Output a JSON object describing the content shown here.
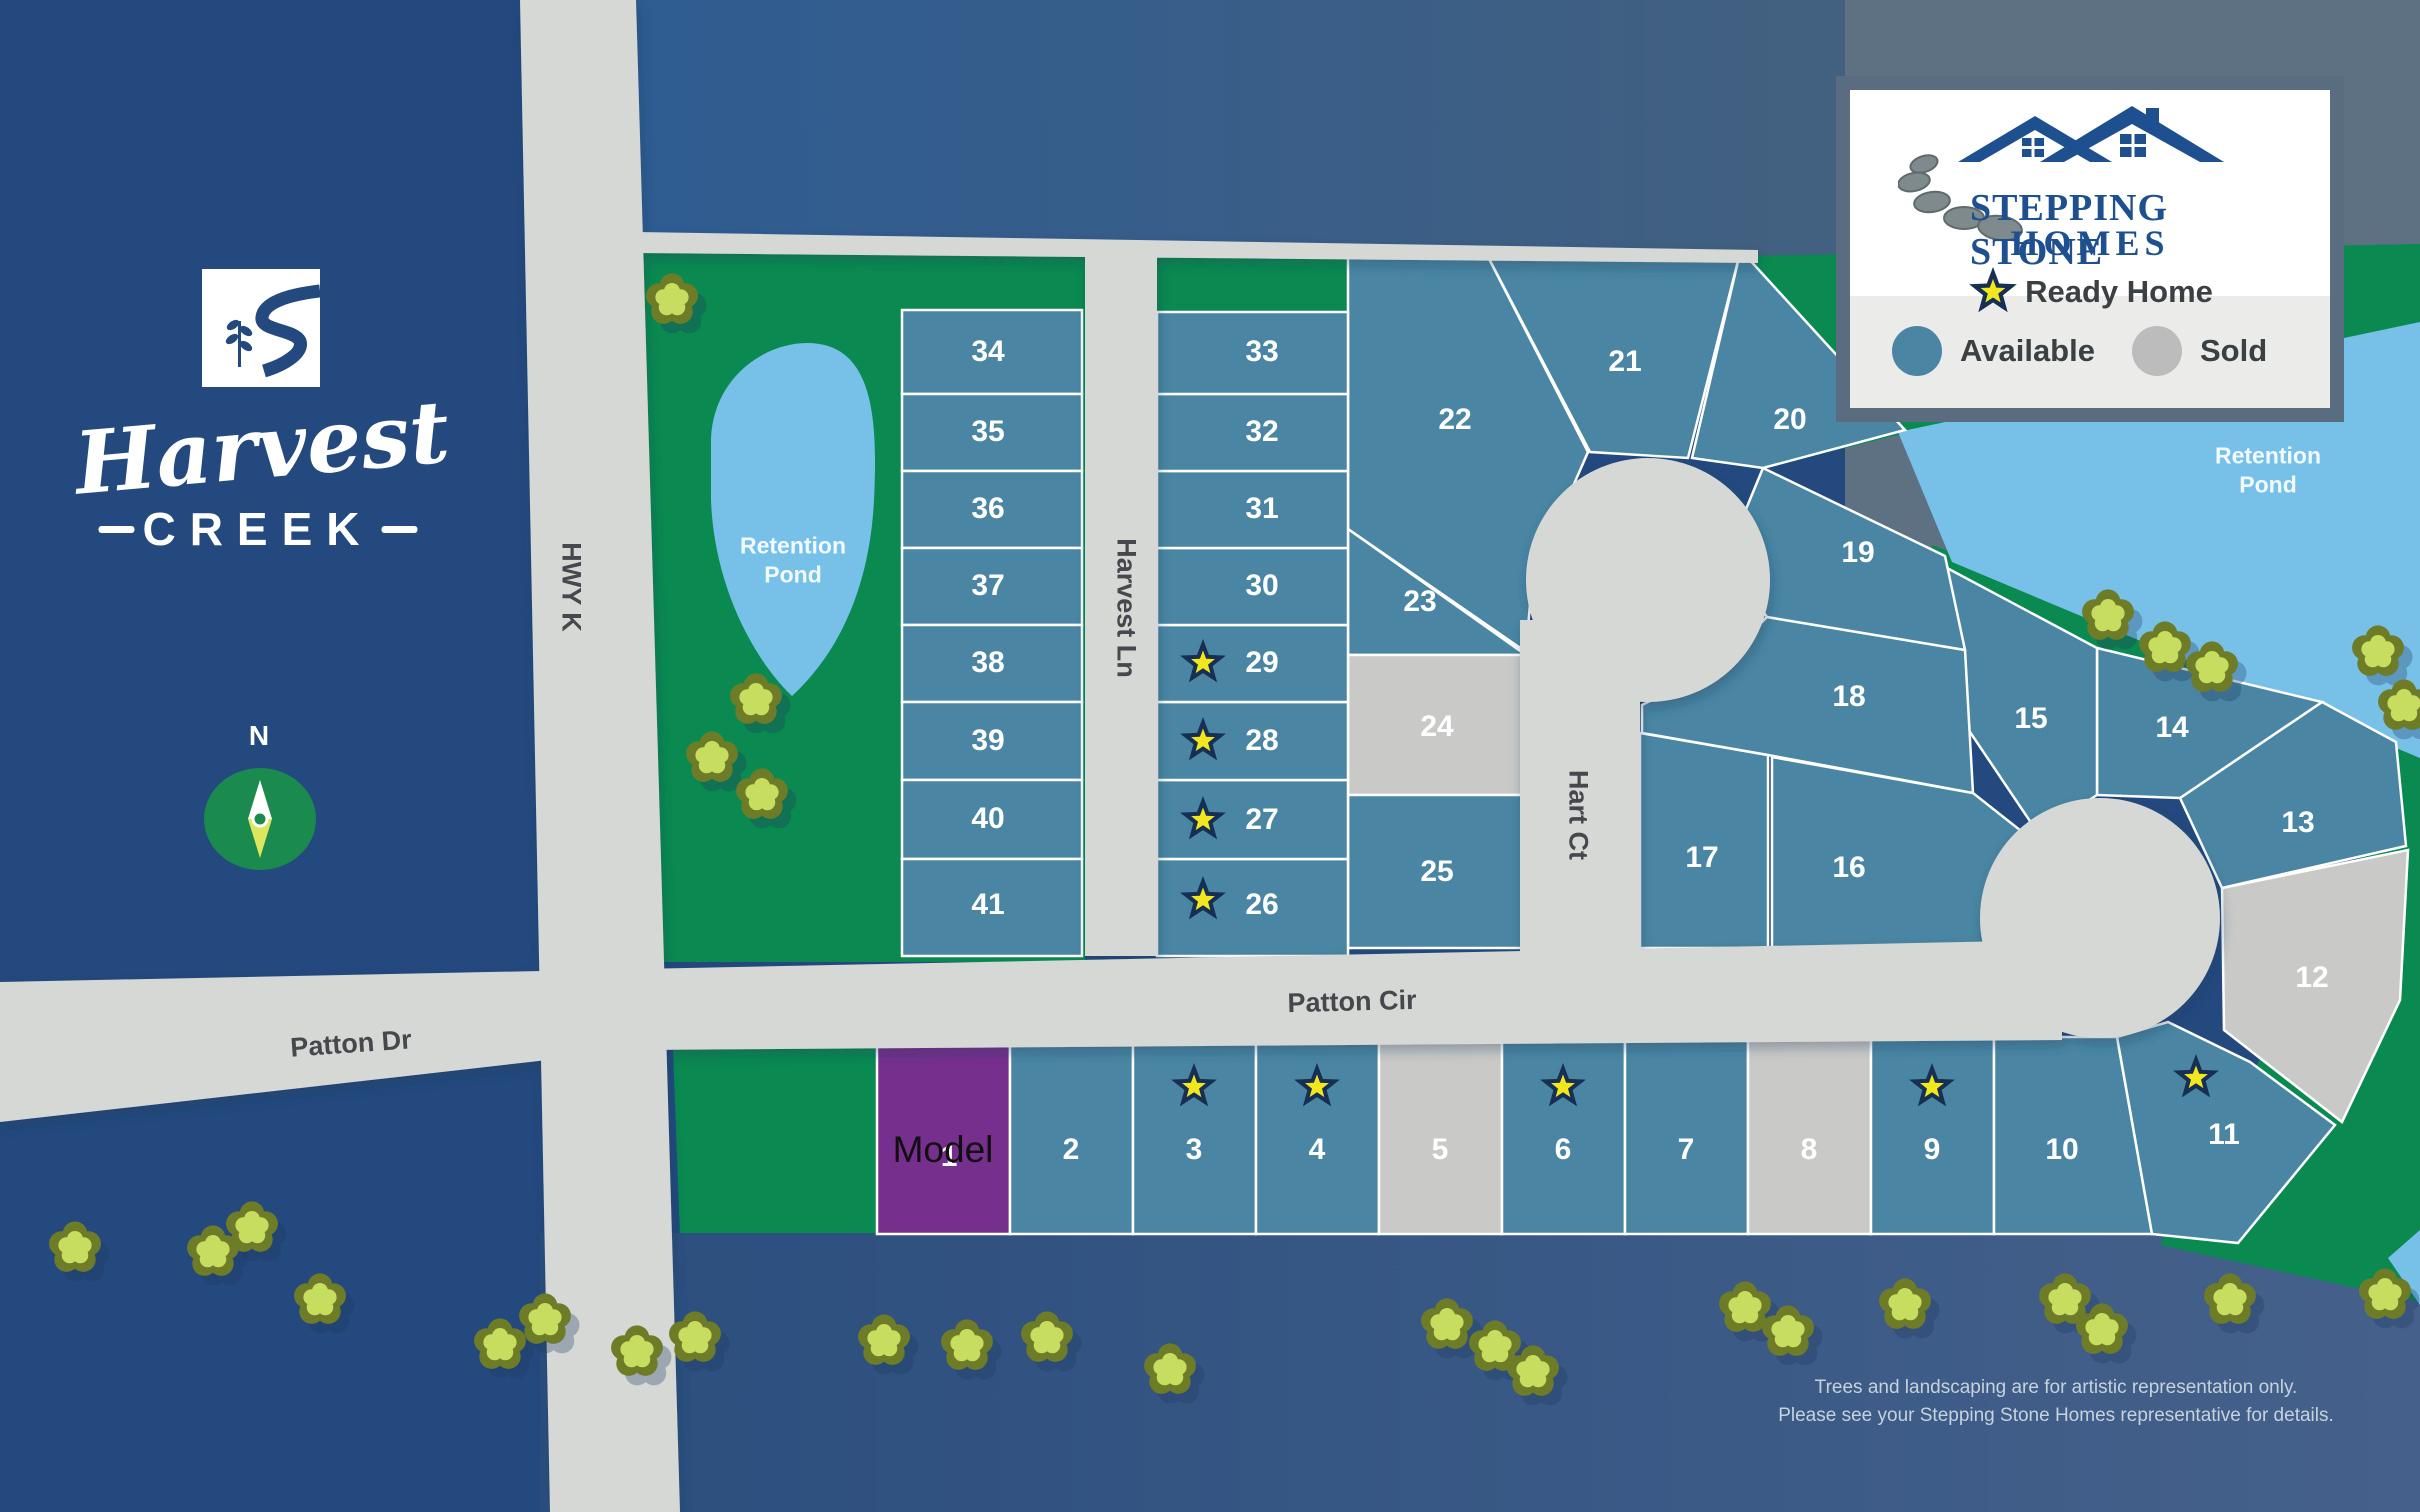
{
  "community": {
    "name_script": "Harvest",
    "name_caps": "CREEK",
    "compass_label": "N"
  },
  "legend": {
    "brand_line1": "STEPPING STONE",
    "brand_line2": "HOMES",
    "ready_home_label": "Ready Home",
    "available_label": "Available",
    "sold_label": "Sold"
  },
  "roads": {
    "hwy_k": "HWY K",
    "harvest_ln": "Harvest Ln",
    "hart_ct": "Hart Ct",
    "patton_cir": "Patton Cir",
    "patton_dr": "Patton Dr"
  },
  "ponds": {
    "left_label": "Retention Pond",
    "right_label": "Retention Pond"
  },
  "disclaimer": {
    "line1": "Trees and landscaping are for artistic representation only.",
    "line2": "Please see your Stepping Stone Homes representative for details."
  },
  "colors": {
    "available_teal": "#4a86a3",
    "sold_gray": "#c9c9c7",
    "model_purple": "#772f8e",
    "map_green": "#0a8a50",
    "pond_blue": "#77c1e9",
    "road_gray": "#d6d8d5",
    "navy_panel": "#24497e",
    "star_navy": "#162f52",
    "star_yellow": "#f2e71e",
    "brand_blue": "#1e4f8f"
  },
  "lots": [
    {
      "number": "1",
      "status": "model",
      "star": false,
      "model_text": "Model"
    },
    {
      "number": "2",
      "status": "available",
      "star": false
    },
    {
      "number": "3",
      "status": "available",
      "star": true
    },
    {
      "number": "4",
      "status": "available",
      "star": true
    },
    {
      "number": "5",
      "status": "sold",
      "star": false
    },
    {
      "number": "6",
      "status": "available",
      "star": true
    },
    {
      "number": "7",
      "status": "available",
      "star": false
    },
    {
      "number": "8",
      "status": "sold",
      "star": false
    },
    {
      "number": "9",
      "status": "available",
      "star": true
    },
    {
      "number": "10",
      "status": "available",
      "star": false
    },
    {
      "number": "11",
      "status": "available",
      "star": true
    },
    {
      "number": "12",
      "status": "sold",
      "star": false
    },
    {
      "number": "13",
      "status": "available",
      "star": false
    },
    {
      "number": "14",
      "status": "available",
      "star": false
    },
    {
      "number": "15",
      "status": "available",
      "star": false
    },
    {
      "number": "16",
      "status": "available",
      "star": false
    },
    {
      "number": "17",
      "status": "available",
      "star": false
    },
    {
      "number": "18",
      "status": "available",
      "star": false
    },
    {
      "number": "19",
      "status": "available",
      "star": false
    },
    {
      "number": "20",
      "status": "available",
      "star": false
    },
    {
      "number": "21",
      "status": "available",
      "star": false
    },
    {
      "number": "22",
      "status": "available",
      "star": false
    },
    {
      "number": "23",
      "status": "available",
      "star": false
    },
    {
      "number": "24",
      "status": "sold",
      "star": false
    },
    {
      "number": "25",
      "status": "available",
      "star": false
    },
    {
      "number": "26",
      "status": "available",
      "star": true
    },
    {
      "number": "27",
      "status": "available",
      "star": true
    },
    {
      "number": "28",
      "status": "available",
      "star": true
    },
    {
      "number": "29",
      "status": "available",
      "star": true
    },
    {
      "number": "30",
      "status": "available",
      "star": false
    },
    {
      "number": "31",
      "status": "available",
      "star": false
    },
    {
      "number": "32",
      "status": "available",
      "star": false
    },
    {
      "number": "33",
      "status": "available",
      "star": false
    },
    {
      "number": "34",
      "status": "available",
      "star": false
    },
    {
      "number": "35",
      "status": "available",
      "star": false
    },
    {
      "number": "36",
      "status": "available",
      "star": false
    },
    {
      "number": "37",
      "status": "available",
      "star": false
    },
    {
      "number": "38",
      "status": "available",
      "star": false
    },
    {
      "number": "39",
      "status": "available",
      "star": false
    },
    {
      "number": "40",
      "status": "available",
      "star": false
    },
    {
      "number": "41",
      "status": "available",
      "star": false
    }
  ]
}
